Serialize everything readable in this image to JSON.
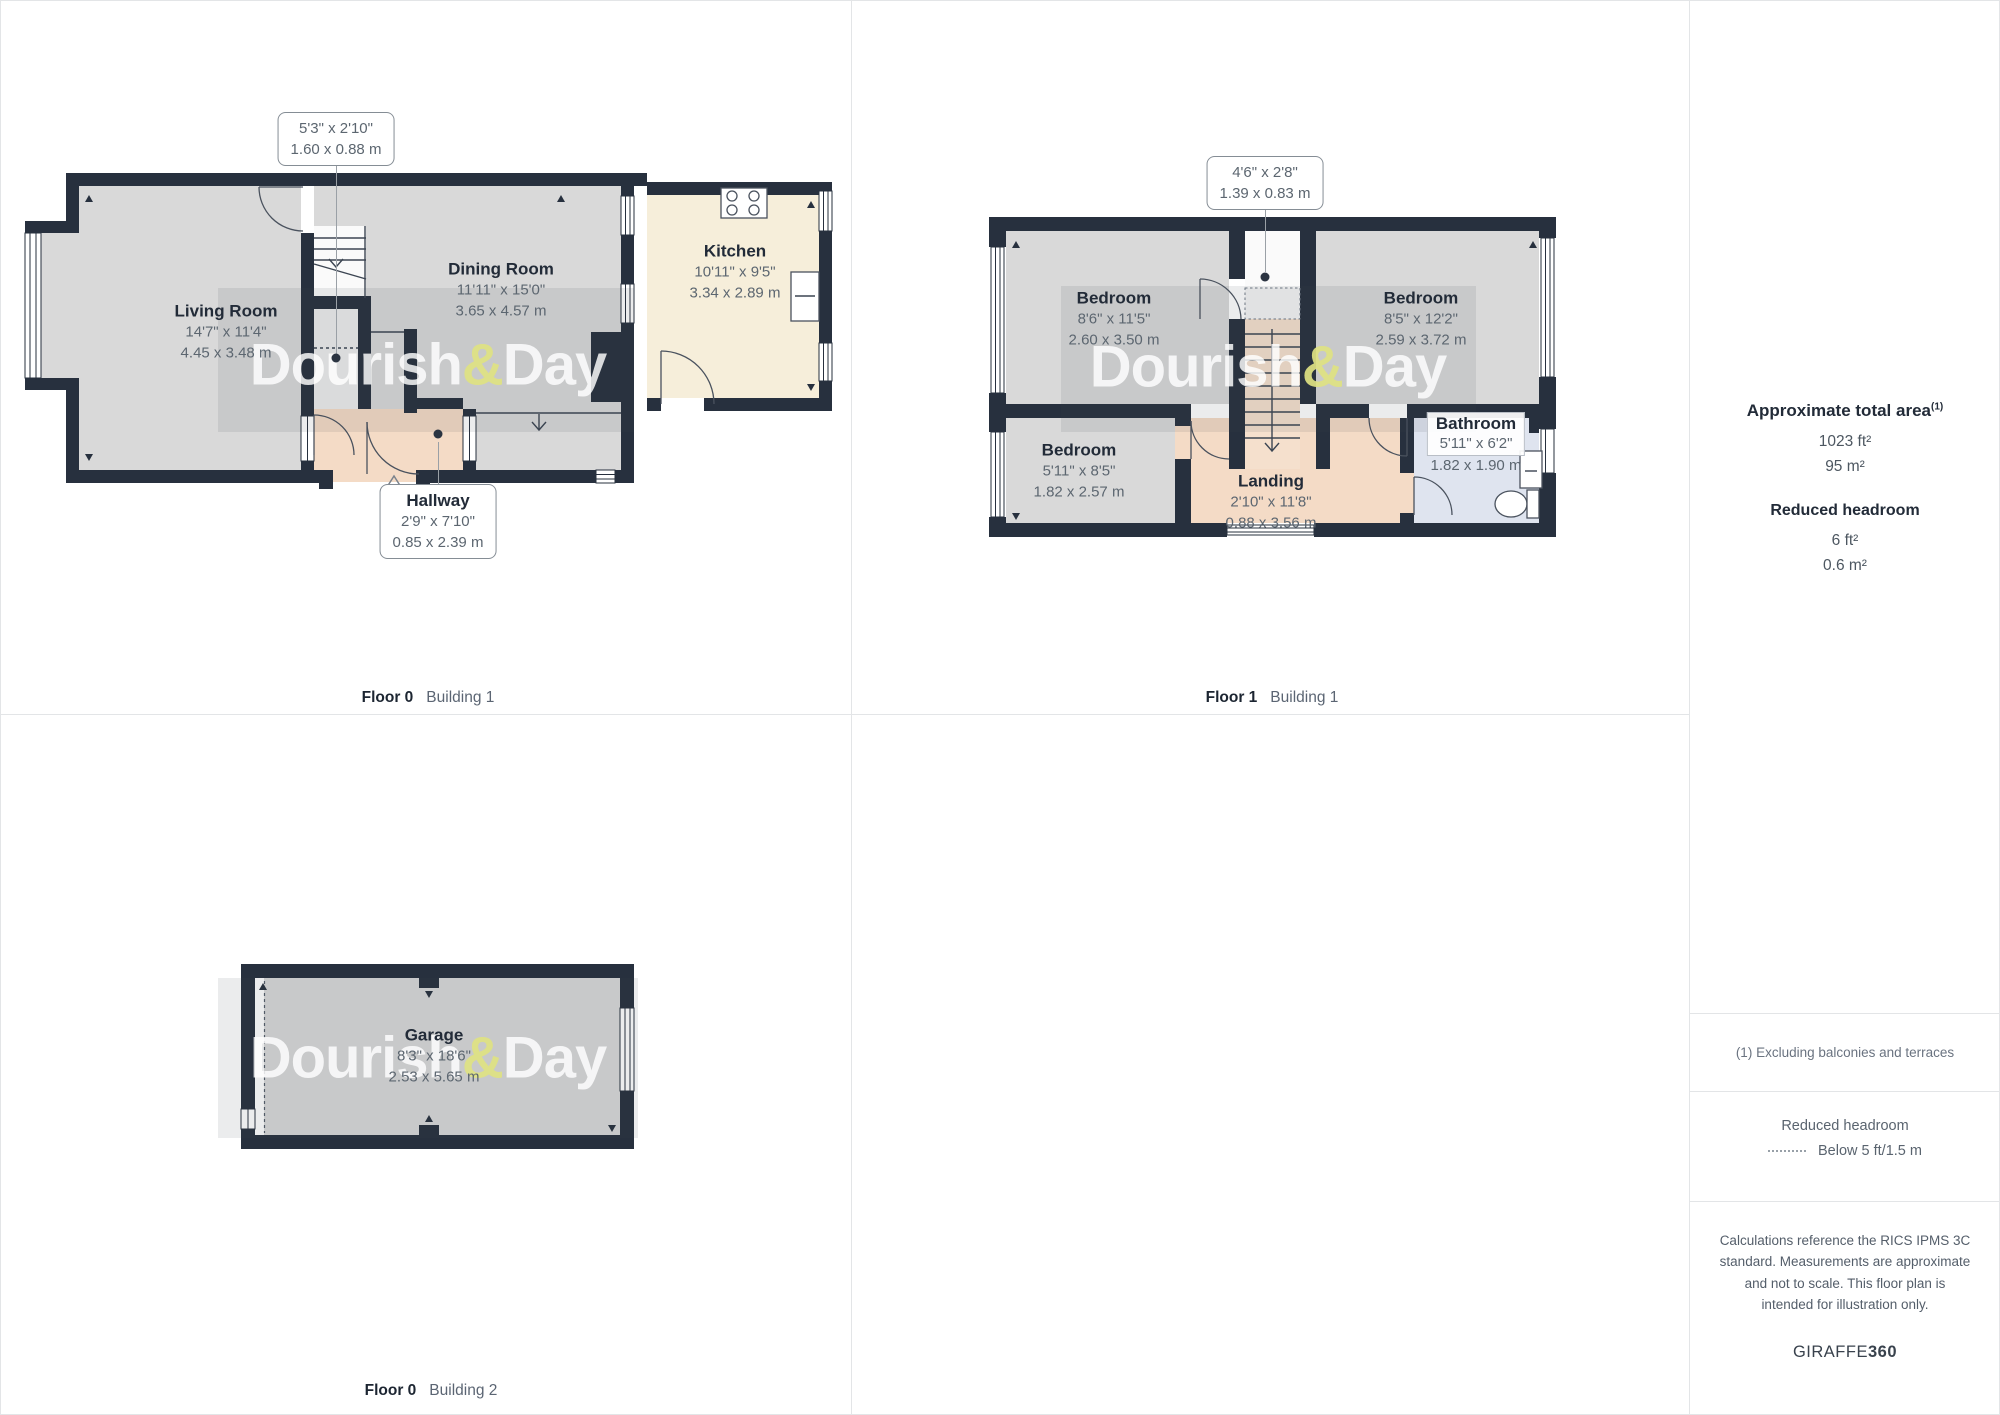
{
  "watermark": {
    "part1": "Dourish",
    "amp": "&",
    "part2": "Day"
  },
  "panels": {
    "floor0_building1": {
      "floor": "Floor 0",
      "building": "Building 1"
    },
    "floor1_building1": {
      "floor": "Floor 1",
      "building": "Building 1"
    },
    "floor0_building2": {
      "floor": "Floor 0",
      "building": "Building 2"
    }
  },
  "rooms": {
    "living_room": {
      "name": "Living Room",
      "imperial": "14'7\" x 11'4\"",
      "metric": "4.45 x 3.48 m"
    },
    "dining_room": {
      "name": "Dining Room",
      "imperial": "11'11\" x 15'0\"",
      "metric": "3.65 x 4.57 m"
    },
    "kitchen": {
      "name": "Kitchen",
      "imperial": "10'11\" x 9'5\"",
      "metric": "3.34 x 2.89 m"
    },
    "hallway": {
      "name": "Hallway",
      "imperial": "2'9\" x 7'10\"",
      "metric": "0.85 x 2.39 m"
    },
    "understairs_cupboard": {
      "imperial": "5'3\" x 2'10\"",
      "metric": "1.60 x 0.88 m"
    },
    "bedroom1": {
      "name": "Bedroom",
      "imperial": "8'6\" x 11'5\"",
      "metric": "2.60 x 3.50 m"
    },
    "bedroom2": {
      "name": "Bedroom",
      "imperial": "8'5\" x 12'2\"",
      "metric": "2.59 x 3.72 m"
    },
    "bedroom3": {
      "name": "Bedroom",
      "imperial": "5'11\" x 8'5\"",
      "metric": "1.82 x 2.57 m"
    },
    "landing": {
      "name": "Landing",
      "imperial": "2'10\" x 11'8\"",
      "metric": "0.88 x 3.56 m"
    },
    "bathroom": {
      "name": "Bathroom",
      "imperial": "5'11\" x 6'2\"",
      "metric": "1.82 x 1.90 m"
    },
    "overstairs_cupboard": {
      "imperial": "4'6\" x 2'8\"",
      "metric": "1.39 x 0.83 m"
    },
    "garage": {
      "name": "Garage",
      "imperial": "8'3\" x 18'6\"",
      "metric": "2.53 x 5.65 m"
    }
  },
  "sidebar": {
    "total_area_label": "Approximate total area",
    "total_area_footnote_marker": "(1)",
    "total_area_imperial": "1023 ft²",
    "total_area_metric": "95 m²",
    "reduced_headroom_label": "Reduced headroom",
    "reduced_headroom_imperial": "6 ft²",
    "reduced_headroom_metric": "0.6 m²",
    "footnote": "(1) Excluding balconies and terraces",
    "legend_title": "Reduced headroom",
    "legend_item": "Below 5 ft/1.5 m",
    "disclaimer": "Calculations reference the RICS IPMS 3C standard. Measurements are approximate and not to scale. This floor plan is intended for illustration only.",
    "brand_name": "GIRAFFE",
    "brand_suffix": "360"
  }
}
